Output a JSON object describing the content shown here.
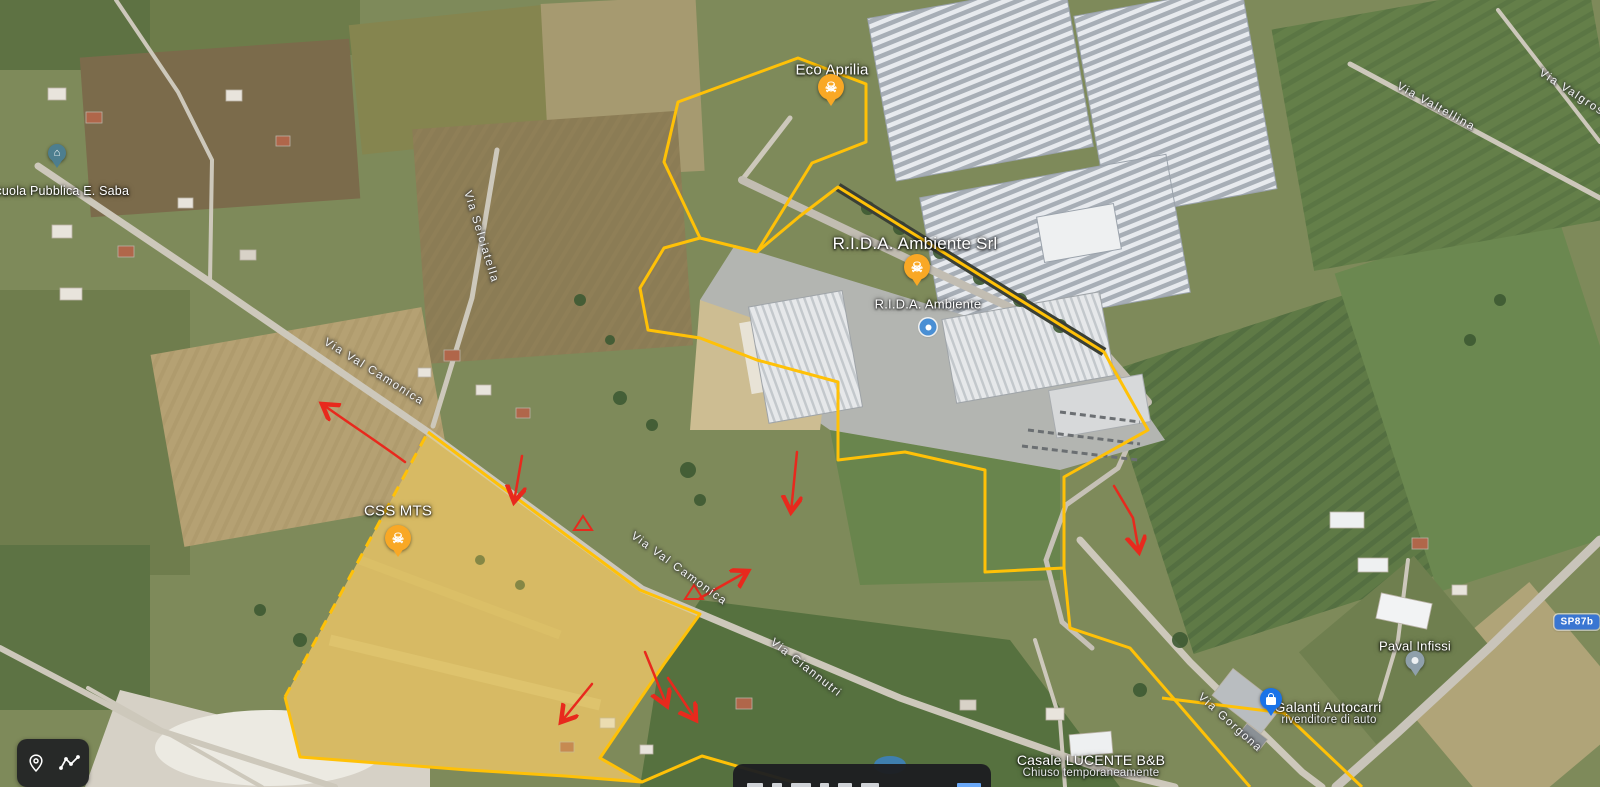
{
  "map": {
    "view": "satellite",
    "colors": {
      "site_boundary": "#FFC107",
      "annotation_red": "#E8291D",
      "route_badge_bg": "#3A76D2",
      "hazard_pin": "#F9A825",
      "store_pin": "#1A73E8",
      "school_pin": "#4D7E8F",
      "generic_pin": "#8FA0AB"
    }
  },
  "pois": {
    "eco_aprilia": {
      "label": "Eco Aprilia"
    },
    "rida_title": {
      "label": "R.I.D.A. Ambiente Srl"
    },
    "rida_marker": {
      "label": "R.I.D.A. Ambiente"
    },
    "css_mts": {
      "label": "CSS MTS"
    },
    "school": {
      "label": "Scuola Pubblica E. Saba"
    },
    "paval": {
      "label": "Paval Infissi"
    },
    "galanti": {
      "label": "Galanti Autocarri",
      "sublabel": "rivenditore di auto"
    },
    "casale": {
      "label": "Casale LUCENTE B&B",
      "sublabel": "Chiuso temporaneamente"
    }
  },
  "roads": {
    "val_camonica_1": "Via Val Camonica",
    "val_camonica_2": "Via Val Camonica",
    "selciatella": "Via Selciatella",
    "giannutri": "Via Giannutri",
    "gorgona": "Via Gorgona",
    "valtellina": "Via Valtellina",
    "valgrosina": "Via Valgrosina",
    "sp_badge": "SP87b"
  },
  "icons": {
    "hazard": "☠",
    "school": "⌂",
    "toolbar": [
      "my-location",
      "measure-path"
    ]
  }
}
